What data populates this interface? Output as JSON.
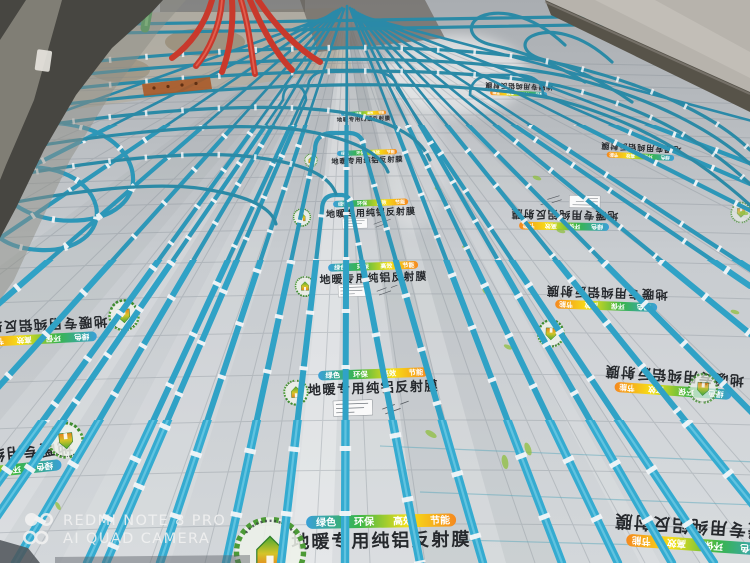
{
  "watermark": {
    "icon": "quad-camera-icon",
    "line1": "REDMI NOTE 8 PRO",
    "line2": "AI QUAD CAMERA",
    "color": "#f2f2f2"
  },
  "foil_print": {
    "banner_words": [
      "绿色",
      "环保",
      "高效",
      "节能"
    ],
    "title": "地暖专用纯铝反射膜",
    "logo_icon": "eco-house-logo"
  },
  "colors": {
    "pipe_blue": "#30a2c6",
    "pipe_red": "#c8392c",
    "rail_green": "#3f9e4e",
    "foil_silver": "#c8ccd0",
    "grid_line": "#7f8890",
    "wall_dark": "#474641",
    "wall_light": "#b7b3ac",
    "baseboard": "#575349",
    "banner_gradient": [
      "#3aa0d8",
      "#39b54a",
      "#f7e017",
      "#f5891f"
    ]
  }
}
